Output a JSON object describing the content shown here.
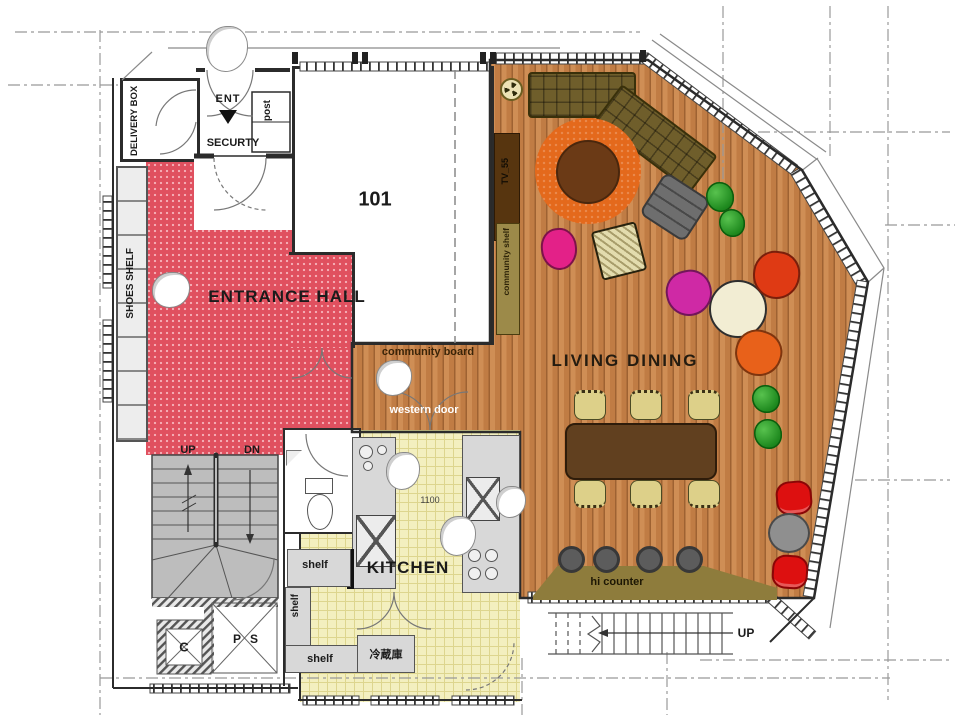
{
  "labels": {
    "room_101": "101",
    "entrance_hall": "ENTRANCE HALL",
    "living_dining": "LIVING DINING",
    "kitchen": "KITCHEN",
    "delivery_box": "DELIVERY BOX",
    "ent": "ENT",
    "security": "SECURTY",
    "post": "post",
    "shoes_shelf": "SHOES SHELF",
    "tv": "TV_55",
    "community_shelf": "community shelf",
    "community_board": "community board",
    "western_door": "western door",
    "hi_counter": "hi counter",
    "shelf_top": "shelf",
    "shelf_left": "shelf",
    "shelf_bottom": "shelf",
    "refrigerator": "冷蔵庫",
    "dim_1100": "1100",
    "stairs_up": "UP",
    "stairs_dn": "DN",
    "ext_stairs_up": "UP",
    "duct": "C",
    "pipe_space": "P S"
  },
  "colors": {
    "entrance_floor": "#e0505f",
    "wood_floor": "#c07c44",
    "kitchen_floor": "#f3efbf",
    "counter": "#d8d8d8",
    "tv_board": "#57350f",
    "shelf_olive": "#9c8a49",
    "sofa": "#6f5e2b",
    "rug": "#e4691c",
    "round_table": "#6b3a16",
    "dining_table": "#61401f",
    "chair_beige": "#ddd089",
    "stool": "#5c5c5c",
    "chair_red": "#dd1010",
    "chair_pink": "#e32188",
    "chair_magenta": "#cf29a5",
    "chair_vermilion": "#df3a14",
    "chair_orange": "#e8611a",
    "plant": "#2f9e2f",
    "armchair": "#6e6e6e",
    "stairs": "#bdbdbd",
    "wall": "#2b2b2b"
  }
}
